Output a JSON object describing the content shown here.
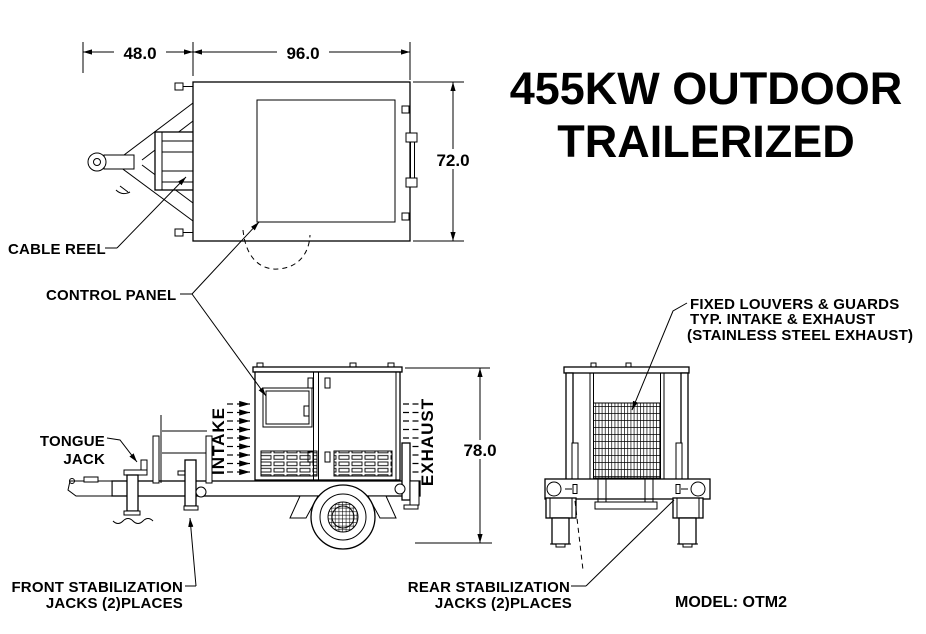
{
  "title": {
    "line1": "455KW OUTDOOR",
    "line2": "TRAILERIZED"
  },
  "model_label": "MODEL: OTM2",
  "dimensions": {
    "tongue_length": "48.0",
    "body_length": "96.0",
    "body_width": "72.0",
    "overall_height": "78.0"
  },
  "callouts": {
    "cable_reel": "CABLE REEL",
    "control_panel": "CONTROL PANEL",
    "tongue_jack": {
      "line1": "TONGUE",
      "line2": "JACK"
    },
    "front_jacks": {
      "line1": "FRONT STABILIZATION",
      "line2": "JACKS (2)PLACES"
    },
    "rear_jacks": {
      "line1": "REAR STABILIZATION",
      "line2": "JACKS (2)PLACES"
    },
    "fixed_louvers": {
      "line1": "FIXED LOUVERS & GUARDS",
      "line2": "TYP. INTAKE & EXHAUST",
      "line3": "(STAINLESS STEEL EXHAUST)"
    },
    "intake": "INTAKE",
    "exhaust": "EXHAUST"
  },
  "colors": {
    "ink": "#000000",
    "paper": "#ffffff"
  }
}
